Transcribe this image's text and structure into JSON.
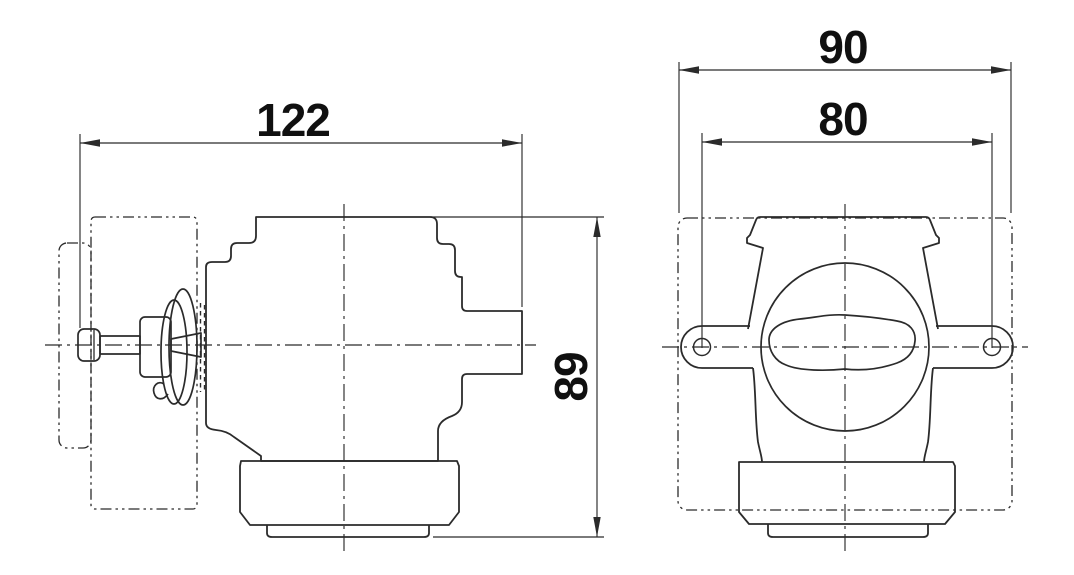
{
  "drawing": {
    "background": "#ffffff",
    "line_color": "#2b2b2b",
    "text_color": "#101010"
  },
  "side_view": {
    "width_dim": "122",
    "height_dim": "89"
  },
  "front_view": {
    "overall_width_dim": "90",
    "hole_spacing_dim": "80"
  }
}
